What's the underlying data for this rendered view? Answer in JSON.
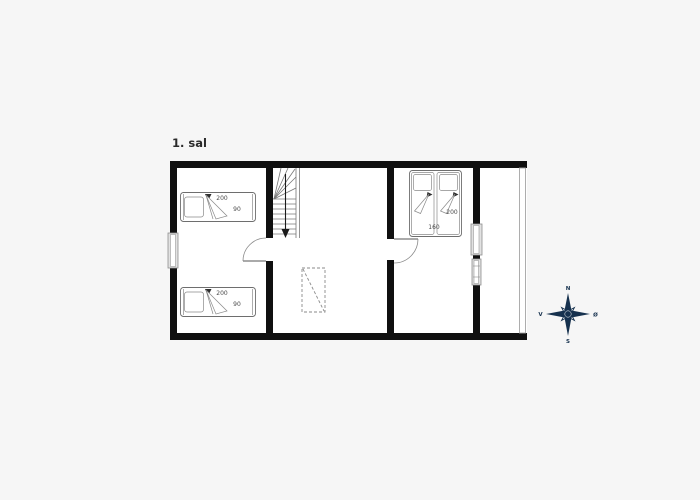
{
  "page": {
    "background": "#f6f6f6",
    "wall_color": "#101010"
  },
  "plan": {
    "title": "1. sal",
    "beds": {
      "single_top": {
        "length": "200",
        "width": "90"
      },
      "single_bottom": {
        "length": "200",
        "width": "90"
      },
      "double": {
        "length": "200",
        "width": "160"
      }
    }
  },
  "compass": {
    "icon": "compass-rose-icon",
    "color": "#16314e",
    "north": "N",
    "south": "S",
    "west": "V",
    "east": "Ø"
  }
}
